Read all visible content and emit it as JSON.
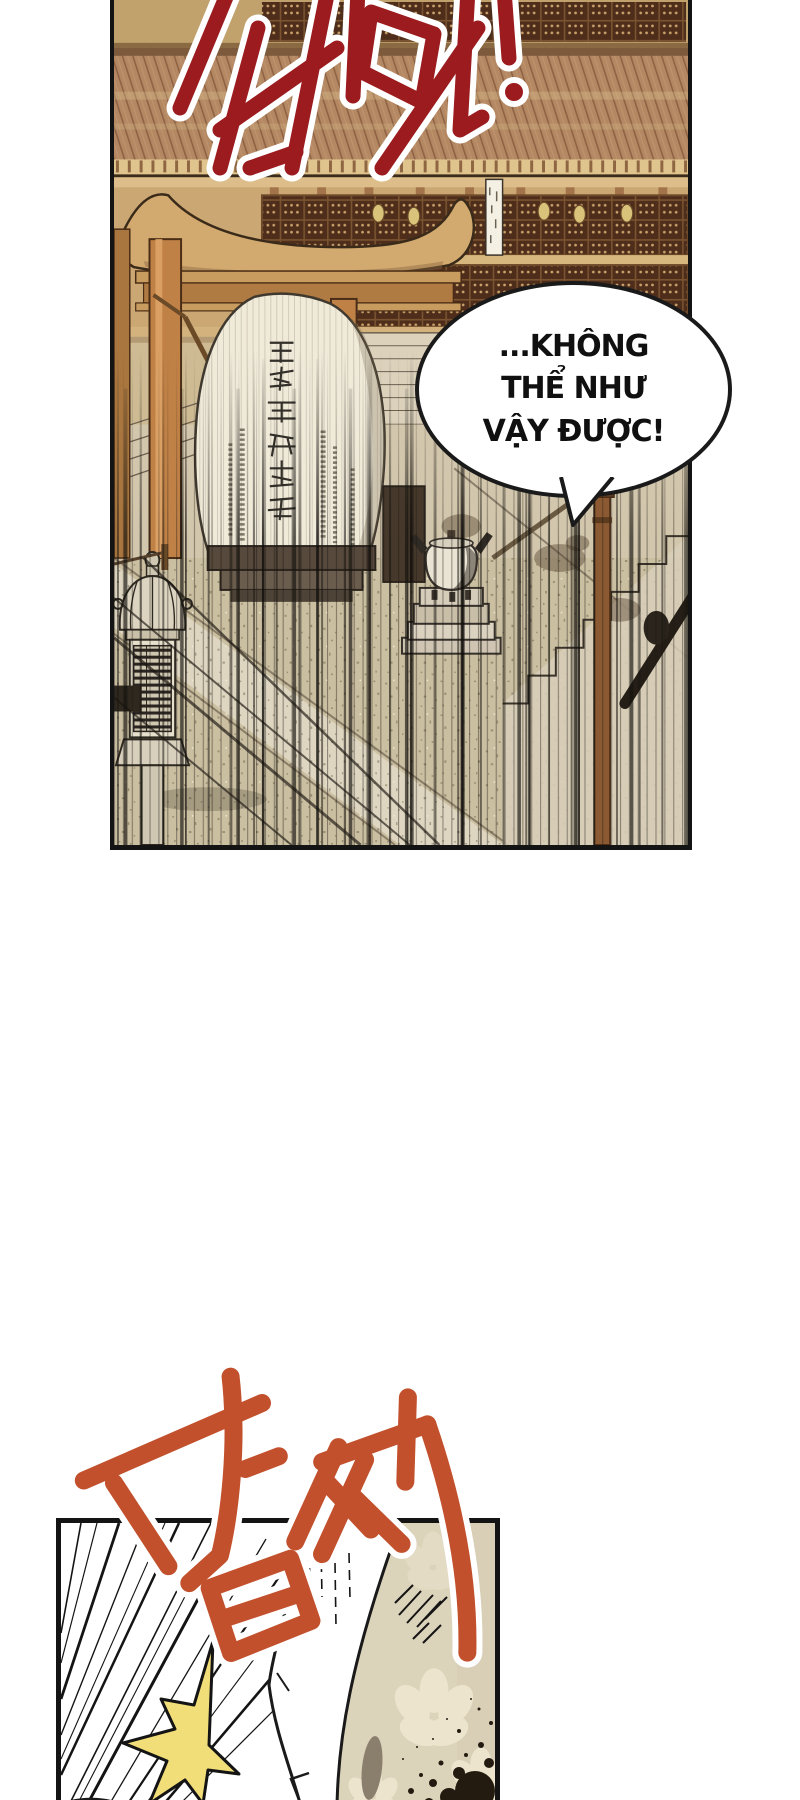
{
  "page": {
    "width": 800,
    "height": 1800,
    "background": "#FFFFFF",
    "kind": "manhwa-comic-page"
  },
  "panel_top": {
    "border_color": "#141414",
    "sfx": {
      "text": "발딱!",
      "color": "#9C1B1F",
      "outline_color": "#FFFFFF"
    },
    "speech_bubble": {
      "lines": [
        "...KHÔNG",
        "THỂ NHƯ",
        "VẬY ĐƯỢC!"
      ],
      "text_color": "#101010",
      "fill": "#FFFFFF",
      "border_color": "#1A1A1A"
    },
    "scene": {
      "description": "traditional temple courtyard with tiled roofs, lattice windows, a gong, a stone stele with vertical hanja calligraphy, incense burner, stone lantern, staircases and vertical speed lines",
      "elements": [
        "tiled-roof",
        "lattice-windows",
        "gate-pillars",
        "hanging-lanterns",
        "white-banner",
        "gong",
        "stone-stele",
        "hanja-inscription",
        "incense-burner",
        "stone-lantern",
        "right-staircase",
        "wooden-pole",
        "gravel-ground",
        "speed-lines"
      ],
      "palette": {
        "base_tan": "#CEBB93",
        "roof": "#B48862",
        "lattice_dark": "#4E2D1B",
        "pillar": "#C08146",
        "stone": "#F0EAD9",
        "ground": "#CBBFA1",
        "gong": "#E6D993"
      }
    }
  },
  "sfx_bottom": {
    "text": "덥석",
    "color": "#C2502C",
    "outline_color": "#FFFFFF"
  },
  "panel_bottom": {
    "border_color": "#141414",
    "background": "#FFFFFF",
    "elements": [
      "radial-speed-lines",
      "white-sleeve",
      "yellow-impact-flash",
      "beige-backdrop",
      "sakura-blossoms",
      "ink-splatter",
      "gray-petal",
      "skin-glimpses"
    ],
    "palette": {
      "flash": "#F2DE79",
      "backdrop": "#DCD3BB",
      "ink": "#241B10",
      "petal_gray": "#8A7E6D",
      "skin": "#F0C49E"
    }
  }
}
